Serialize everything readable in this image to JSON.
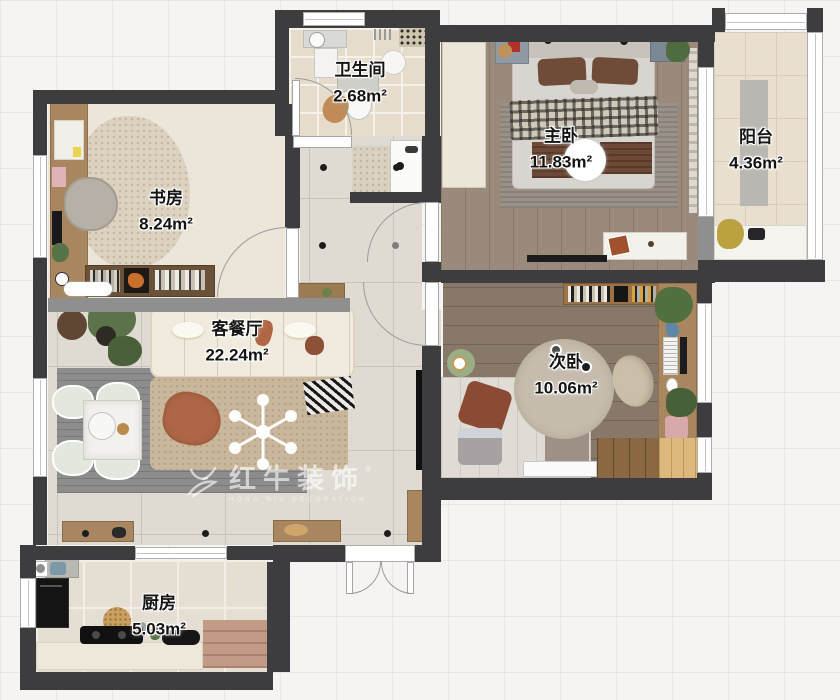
{
  "page": {
    "type": "apartment-floor-plan",
    "background": "#f5f4f2",
    "grid_line": "#e9e7e3"
  },
  "rooms": [
    {
      "id": "bathroom",
      "name": "卫生间",
      "area": "2.68m²"
    },
    {
      "id": "study",
      "name": "书房",
      "area": "8.24m²"
    },
    {
      "id": "master-bedroom",
      "name": "主卧",
      "area": "11.83m²"
    },
    {
      "id": "balcony",
      "name": "阳台",
      "area": "4.36m²"
    },
    {
      "id": "living-dining",
      "name": "客餐厅",
      "area": "22.24m²"
    },
    {
      "id": "second-bedroom",
      "name": "次卧",
      "area": "10.06m²"
    },
    {
      "id": "kitchen",
      "name": "厨房",
      "area": "5.03m²"
    }
  ],
  "watermark": {
    "logo_icon": "bull-logo",
    "registered_mark": "®",
    "brand": "红牛装饰",
    "brand_sub": "HONG NIU DECORATION"
  },
  "colors": {
    "wall": "#3d3d3f",
    "half_wall": "#8f8f8f",
    "wood_accent": "#a8865f",
    "terracotta_accent": "#ad6746",
    "master_floor": "#998a7c",
    "bedroom2_floor": "#877869"
  }
}
